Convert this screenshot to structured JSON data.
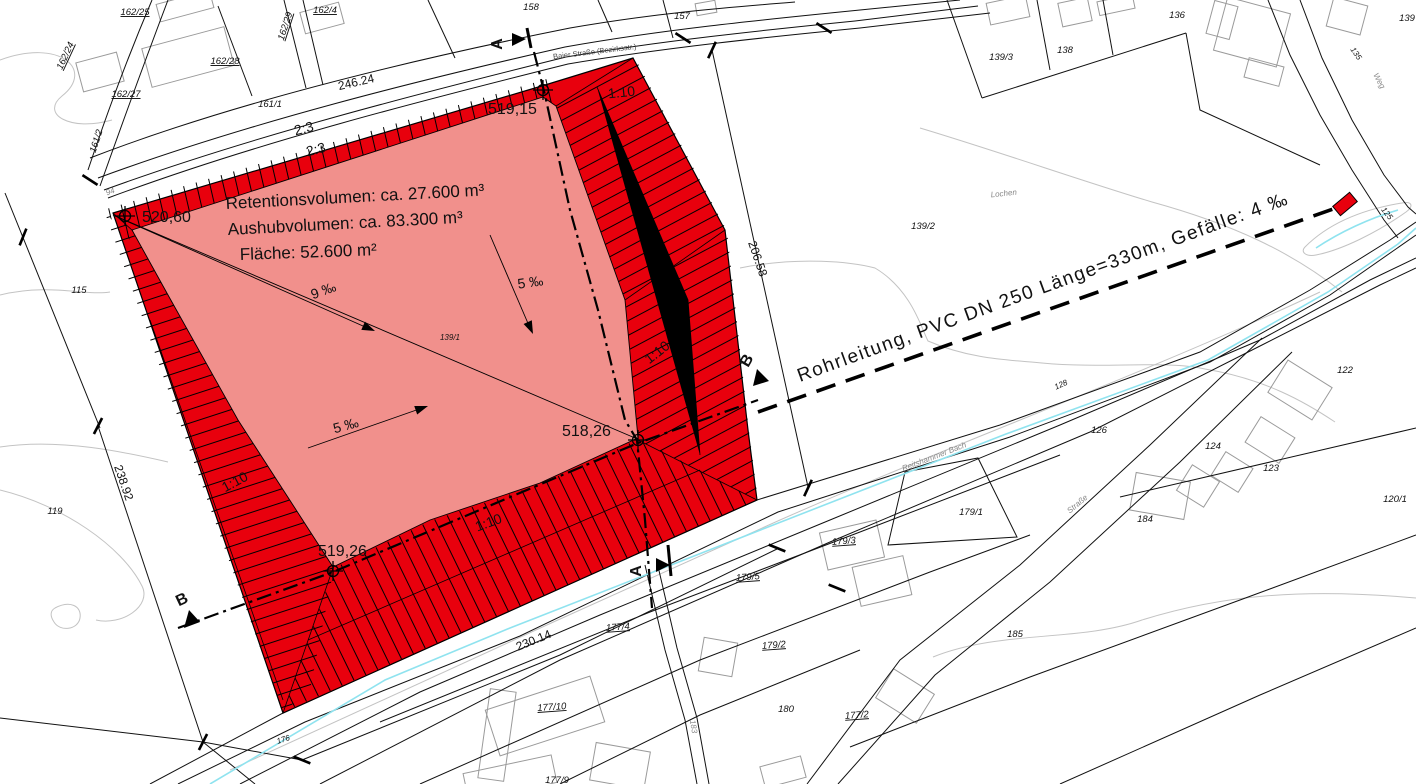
{
  "colors": {
    "embankment_fill": "#e8000d",
    "basin_fill": "#f1908c",
    "stream": "#8fe3ef",
    "contour": "#c3c3c3",
    "building_outline": "#9a9a9a"
  },
  "volume_annotation": {
    "line1": "Retentionsvolumen: ca. 27.600 m³",
    "line2": "Aushubvolumen: ca. 83.300 m³",
    "line3": "Fläche: 52.600 m²"
  },
  "pipeline": {
    "label": "Rohrleitung, PVC DN 250 Länge=330m, Gefälle: 4 ‰"
  },
  "elevation_points": {
    "northwest": "520,60",
    "north": "519,15",
    "east": "518,26",
    "south": "519,26"
  },
  "slopes": {
    "embankment_ratio_a": "2:3",
    "embankment_ratio_b": "2:3",
    "ratio_north": "1:10",
    "ratio_east": "1:10",
    "ratio_west": "1:10",
    "ratio_south": "1:10",
    "gradient_9": "9 ‰",
    "gradient_5_center": "5 ‰",
    "gradient_5_west": "5 ‰"
  },
  "dimensions": {
    "north": "246.24",
    "east": "206.58",
    "west": "238.92",
    "south": "230.14"
  },
  "sections": {
    "a": "A",
    "b": "B"
  },
  "places": {
    "street": "Baier Straße (Bezirksstr.)",
    "stream": "Reitshammer Bach",
    "road": "Straße",
    "way": "Weg",
    "field": "Lochen",
    "path": "183"
  },
  "parcels": {
    "p162_25": "162/25",
    "p162_4": "162/4",
    "p158": "158",
    "p157": "157",
    "p136": "136",
    "p139": "139",
    "p162_24": "162/24",
    "p162_29": "162/29",
    "p162_28": "162/28",
    "p162_27": "162/27",
    "p161_1": "161/1",
    "p161_2": "161/2",
    "p94": "94",
    "p139_3": "139/3",
    "p138": "138",
    "p135": "135",
    "p115": "115",
    "p139_2": "139/2",
    "p139_1": "139/1",
    "p128": "128",
    "p122": "122",
    "p126": "126",
    "p124": "124",
    "p123": "123",
    "p120_1": "120/1",
    "p119": "119",
    "p179_1": "179/1",
    "p184": "184",
    "p179_3": "179/3",
    "p179_5": "179/5",
    "p177_4": "177/4",
    "p179_2": "179/2",
    "p185": "185",
    "p177_10": "177/10",
    "p180": "180",
    "p177_2": "177/2",
    "p177_9": "177/9",
    "p176": "176",
    "p125": "125"
  }
}
